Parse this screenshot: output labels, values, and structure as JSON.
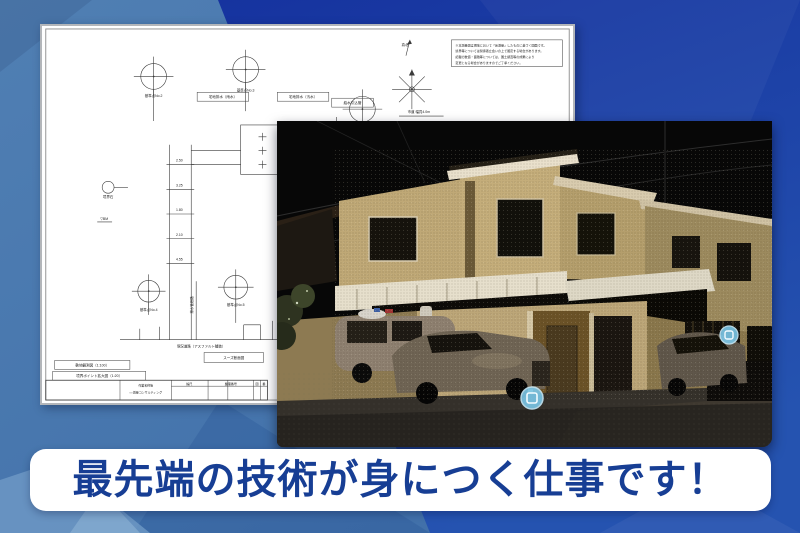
{
  "banner": {
    "text": "最先端の技術が身につく仕事です！",
    "text_color": "#173e94",
    "bg_color": "#ffffff"
  },
  "background": {
    "left_color": "#4a7ab0",
    "right_color": "#1b3ba6",
    "bottom_right_color": "#2553b0",
    "accent_light_color": "#7fa3c9"
  },
  "blueprint": {
    "page_bg": "#ffffff",
    "line_color": "#3a3a3a",
    "north_label": "真北",
    "note_lines": [
      "※本測量図は現地において「仮測量」したものに基づく図面です。",
      "境界等については関係者立会いの上で確定する場合があります。",
      "記載の数値・面積等については、国土調査等の成果により",
      "変更となる場合がありますのでご了承ください。"
    ],
    "boxed_labels": [
      {
        "x": 156,
        "y": 67,
        "w": 52,
        "h": 9,
        "text": "宅地排水（雨水）"
      },
      {
        "x": 237,
        "y": 67,
        "w": 52,
        "h": 9,
        "text": "宅地排水（汚水）"
      },
      {
        "x": 292,
        "y": 73,
        "w": 42,
        "h": 9,
        "text": "給水引込管"
      },
      {
        "x": 12,
        "y": 338,
        "w": 76,
        "h": 9,
        "text": "敷地観測図（1:100）"
      },
      {
        "x": 10,
        "y": 349,
        "w": 94,
        "h": 9,
        "text": "境界ポイント拡大図（1:20）"
      },
      {
        "x": 163,
        "y": 330,
        "w": 60,
        "h": 10,
        "text": "スーズ断面図"
      }
    ],
    "tiny_labels": [
      {
        "x": 112,
        "y": 72,
        "text": "基準点No.2"
      },
      {
        "x": 205,
        "y": 66,
        "text": "基準点No.3"
      },
      {
        "x": 323,
        "y": 106,
        "text": "引照点No.1"
      },
      {
        "x": 107,
        "y": 288,
        "text": "基準点No.4"
      },
      {
        "x": 195,
        "y": 283,
        "text": "基準点No.5"
      },
      {
        "x": 66,
        "y": 174,
        "text": "境界石"
      },
      {
        "x": 366,
        "y": 20,
        "text": "真北"
      },
      {
        "x": 380,
        "y": 88,
        "text": "市道 幅員4.0m"
      },
      {
        "x": 253,
        "y": 113,
        "text": "雨水枡"
      },
      {
        "x": 253,
        "y": 127,
        "text": "汚水枡"
      },
      {
        "x": 253,
        "y": 141,
        "text": "量水器"
      },
      {
        "x": 270,
        "y": 106,
        "text": "φ100"
      },
      {
        "x": 270,
        "y": 119,
        "text": "φ75"
      },
      {
        "x": 138,
        "y": 137,
        "text": "2.50"
      },
      {
        "x": 138,
        "y": 162,
        "text": "3.25"
      },
      {
        "x": 138,
        "y": 187,
        "text": "1.80"
      },
      {
        "x": 138,
        "y": 212,
        "text": "2.10"
      },
      {
        "x": 138,
        "y": 237,
        "text": "4.55"
      },
      {
        "x": 62,
        "y": 196,
        "text": "▽BM"
      },
      {
        "x": 160,
        "y": 325,
        "text": "現況道路（アスファルト舗装）"
      },
      {
        "x": 152,
        "y": 282,
        "text": "排水管経路",
        "rotate": -90
      }
    ],
    "title_block": {
      "name_label": "作業名称等",
      "company": "○○測量コンサルティング",
      "headers": [
        "縮尺",
        "整理番号",
        "図",
        "番"
      ]
    }
  },
  "photo": {
    "content": "3D point-cloud scan of two-story house at night with parked cars",
    "marker_color": "#7cc7e8",
    "marker_icons": [
      "scan-position-marker",
      "scan-position-marker"
    ],
    "sky_color": "#070707",
    "wall_color": "#c4ad7a"
  }
}
